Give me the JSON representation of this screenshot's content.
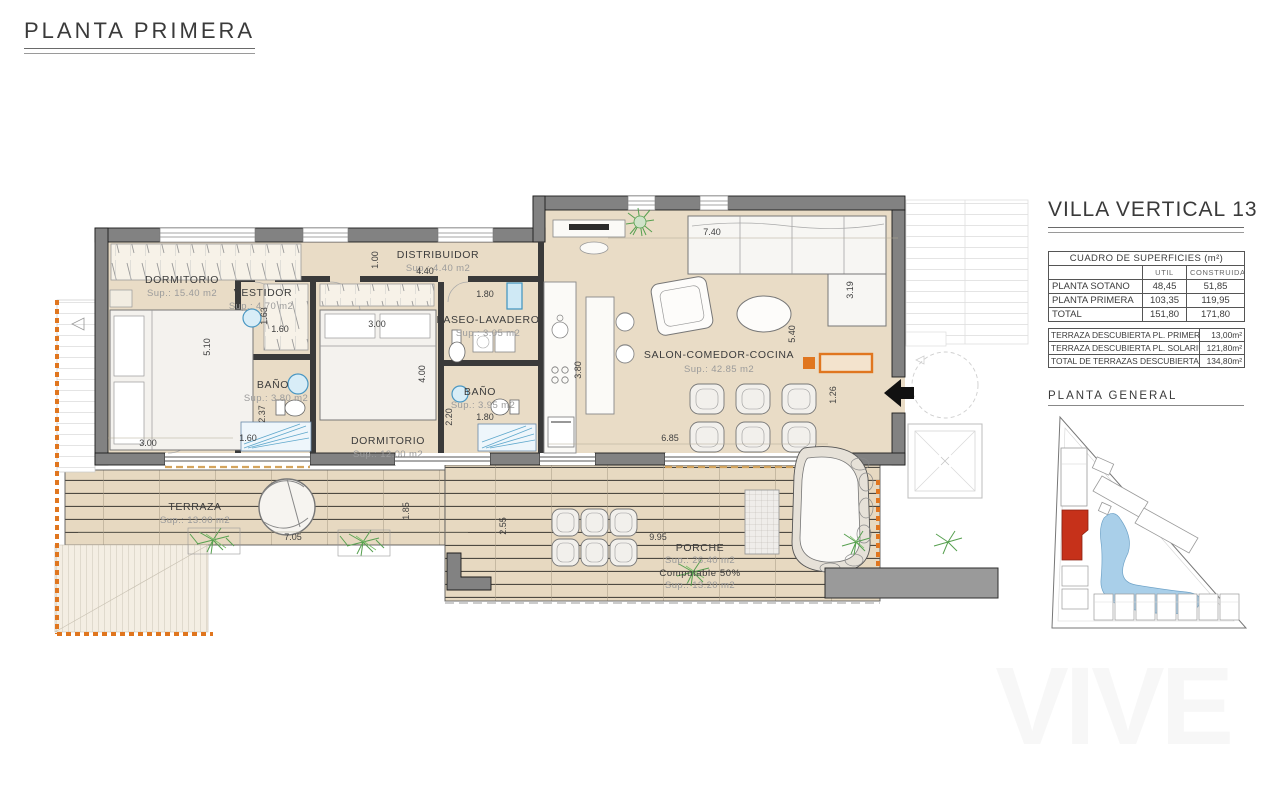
{
  "page": {
    "title": "PLANTA PRIMERA",
    "watermark": "VIVE"
  },
  "panel": {
    "title": "VILLA VERTICAL 13",
    "surfaces_table": {
      "title": "CUADRO DE SUPERFICIES (m²)",
      "columns": [
        "UTIL",
        "CONSTRUIDA"
      ],
      "rows": [
        {
          "name": "PLANTA SOTANO",
          "util": "48,45",
          "construida": "51,85"
        },
        {
          "name": "PLANTA PRIMERA",
          "util": "103,35",
          "construida": "119,95"
        },
        {
          "name": "TOTAL",
          "util": "151,80",
          "construida": "171,80"
        }
      ]
    },
    "terraces_table": {
      "rows": [
        {
          "name": "TERRAZA DESCUBIERTA PL. PRIMERA",
          "value": "13,00m²"
        },
        {
          "name": "TERRAZA DESCUBIERTA PL. SOLARIUM",
          "value": "121,80m²"
        },
        {
          "name": "TOTAL DE TERRAZAS DESCUBIERTAS",
          "value": "134,80m²"
        }
      ]
    },
    "site_plan_title": "PLANTA GENERAL"
  },
  "plan": {
    "rooms": [
      {
        "name": "DORMITORIO",
        "sup": "Sup.: 15.40 m2"
      },
      {
        "name": "VESTIDOR",
        "sup": "Sup.: 4.70 m2"
      },
      {
        "name": "BAÑO",
        "sup": "Sup.: 3.80 m2"
      },
      {
        "name": "DISTRIBUIDOR",
        "sup": "Sup.: 4.40 m2"
      },
      {
        "name": "PASEO-LAVADERO",
        "sup": "Sup.: 3.05 m2"
      },
      {
        "name": "BAÑO",
        "sup": "Sup.: 3.95 m2"
      },
      {
        "name": "DORMITORIO",
        "sup": "Sup.: 12.00 m2"
      },
      {
        "name": "SALON-COMEDOR-COCINA",
        "sup": "Sup.: 42.85 m2"
      },
      {
        "name": "TERRAZA",
        "sup": "Sup.: 13.00 m2"
      },
      {
        "name": "PORCHE",
        "sup": "Sup.: 26.40 m2",
        "note": "Computable 50%",
        "note_sup": "Sup.: 13.20 m2"
      }
    ],
    "dims": [
      "5.10",
      "3.00",
      "1.60",
      "2.37",
      "1.63",
      "1.60",
      "1.00",
      "4.40",
      "3.00",
      "4.00",
      "1.80",
      "2.20",
      "1.80",
      "3.80",
      "7.40",
      "3.19",
      "5.40",
      "1.26",
      "6.85",
      "7.05",
      "1.85",
      "2.55",
      "9.95"
    ]
  }
}
